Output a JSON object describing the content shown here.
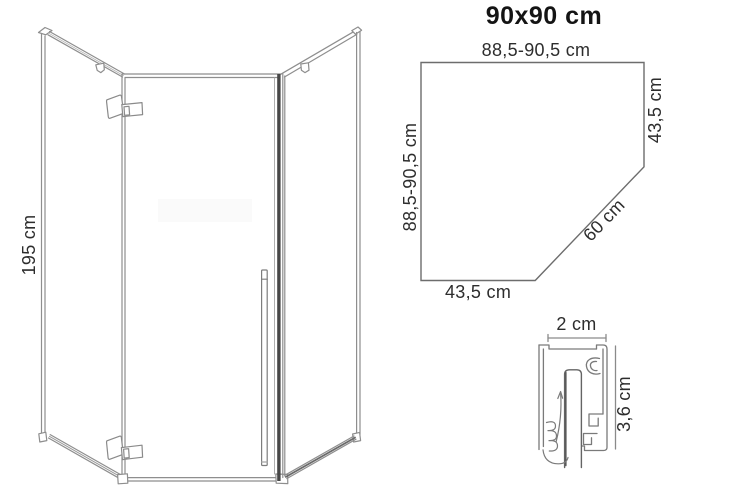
{
  "title": "90x90 cm",
  "front_view": {
    "height_label": "195 cm"
  },
  "plan_view": {
    "top_label": "88,5-90,5 cm",
    "left_label": "88,5-90,5 cm",
    "right_label": "43,5 cm",
    "diagonal_label": "60 cm",
    "bottom_label": "43,5 cm"
  },
  "profile_view": {
    "width_label": "2 cm",
    "height_label": "3,6 cm"
  },
  "colors": {
    "background": "#ffffff",
    "front_line": "#8e8e8e",
    "plan_line": "#6d6d6d",
    "profile_line": "#7a7a7a",
    "dark_band": "#474747",
    "text": "#2d2d2d",
    "title_text": "#141414"
  }
}
